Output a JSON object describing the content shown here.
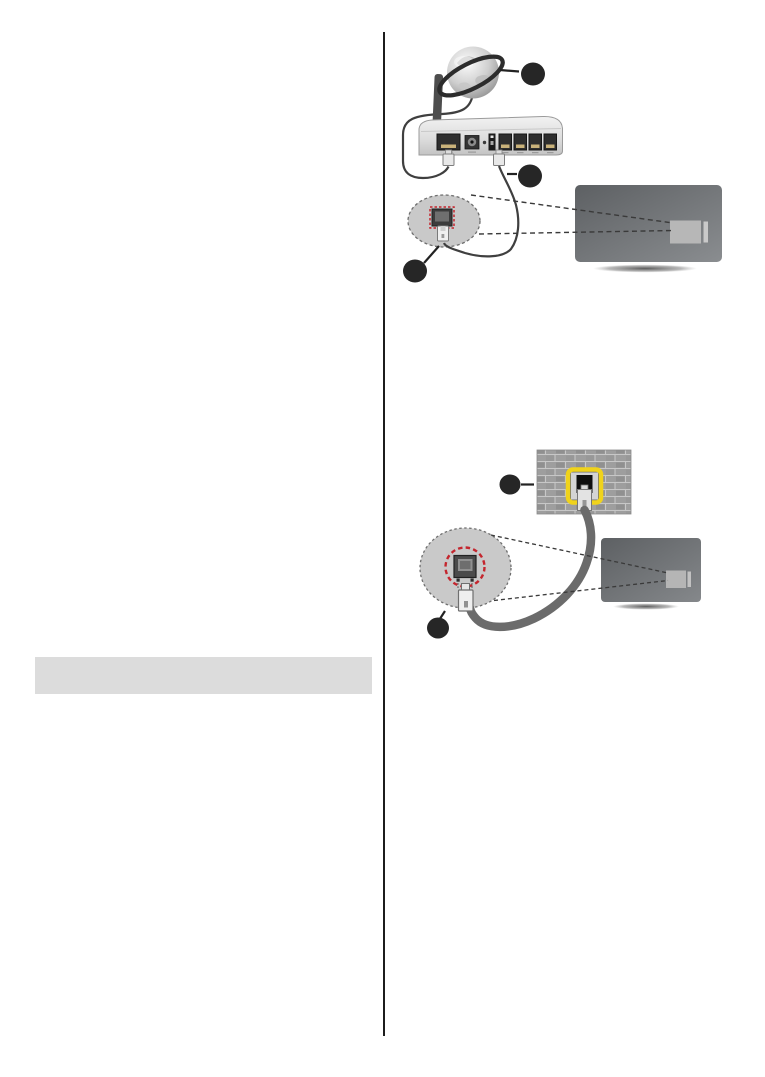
{
  "page": {
    "width_px": 765,
    "height_px": 1077,
    "background": "#ffffff"
  },
  "colors": {
    "divider": "#1c1c1c",
    "heading_bar": "#dcdcdc",
    "callout_fill": "#262626",
    "leader_line": "#222222",
    "highlight_red": "#c4262e",
    "highlight_yellow": "#f0d31b",
    "bubble_fill": "#c9c9c9",
    "bubble_border": "#6e6e6e",
    "cable_thin": "#3f3f3f",
    "cable_thick": "#6b6b6b",
    "port_dark": "#2e2e2e",
    "port_pins_gold": "#c9b27a",
    "tv_panel": "#b7b7b7",
    "brick_wall": "#9e9e9e",
    "projection_line": "#3a3a3a"
  },
  "left_column": {
    "heading_bar_text": ""
  },
  "figures": {
    "top": {
      "name": "wired-internet-connection-via-router",
      "components": [
        "internet-globe-icon",
        "wireless-router-icon",
        "wan-cable",
        "lan-cable",
        "lan-port-magnifier",
        "tv-rear-view"
      ],
      "callouts": [
        {
          "name": "callout-internet",
          "shape": "filled-circle",
          "text": ""
        },
        {
          "name": "callout-lan-cable",
          "shape": "filled-circle",
          "text": ""
        },
        {
          "name": "callout-tv-lan-port",
          "shape": "filled-circle",
          "text": ""
        }
      ]
    },
    "bottom": {
      "name": "wired-connection-via-wall-socket",
      "components": [
        "brick-wall-network-socket-icon",
        "ethernet-cable",
        "lan-port-magnifier",
        "tv-rear-view"
      ],
      "callouts": [
        {
          "name": "callout-wall-socket",
          "shape": "filled-circle",
          "text": ""
        },
        {
          "name": "callout-tv-lan-port",
          "shape": "filled-circle",
          "text": ""
        }
      ]
    }
  }
}
